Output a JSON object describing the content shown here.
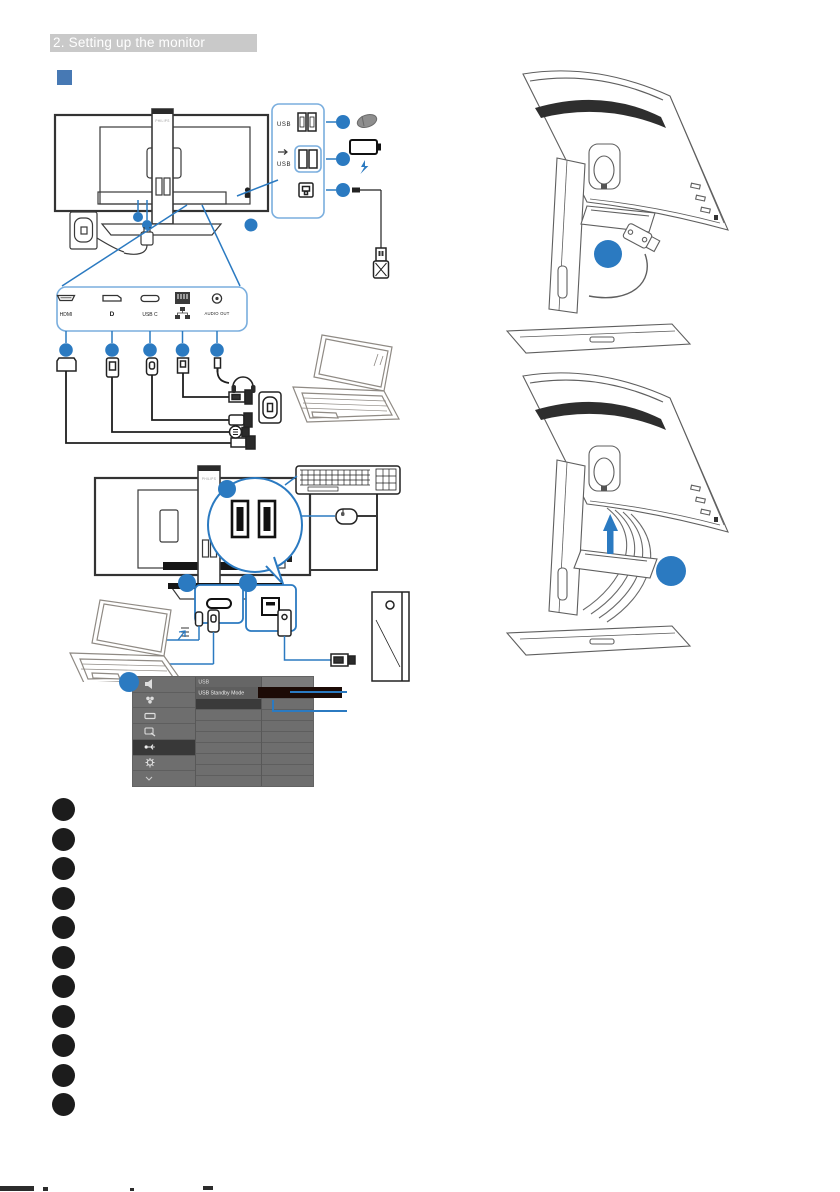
{
  "header": {
    "title": "2. Setting up the monitor"
  },
  "brand": "PHILIPS",
  "colors": {
    "accent_blue": "#2b7ac1",
    "callout_blue": "#7aaede",
    "header_bg": "#c9c9c9",
    "header_text": "#ffffff",
    "section_square": "#4779b4",
    "osd_bg": "#6e6e6e",
    "osd_selected": "#383838",
    "osd_value_dark": "#1c0b06",
    "bullet_black": "#1c1c1c"
  },
  "rear_panel_callout": {
    "usb_label": "USB",
    "usb_fast_label": "USB",
    "icons": [
      "usb-downstream-ports-icon",
      "usb-fast-charge-ports-icon",
      "usb-b-upstream-icon",
      "mouse-icon",
      "battery-charging-icon",
      "usb-cable-plug-icon",
      "kensington-lock-icon"
    ]
  },
  "connector_strip": {
    "labels": {
      "hdmi": "HDMI",
      "displayport": "D",
      "usbc": "USB C",
      "audio": "AUDIO OUT"
    },
    "icons": [
      "hdmi-port-icon",
      "displayport-port-icon",
      "usbc-port-icon",
      "ethernet-port-icon",
      "audio-out-port-icon"
    ]
  },
  "peripherals": {
    "icons": [
      "laptop-icon",
      "headphones-icon",
      "wall-outlet-icon",
      "power-plug-icon",
      "keyboard-icon",
      "mouse-icon",
      "desktop-tower-icon"
    ]
  },
  "osd_menu": {
    "menu_items": [
      "USB",
      "USB Standby Mode"
    ],
    "sidebar_icons": [
      "speaker-icon",
      "color-icon",
      "input-icon",
      "picture-icon",
      "usb-icon",
      "setup-gear-icon",
      "arrow-down-icon"
    ]
  },
  "step_markers": {
    "count": 2
  },
  "legend": {
    "bullet_count": 11
  }
}
